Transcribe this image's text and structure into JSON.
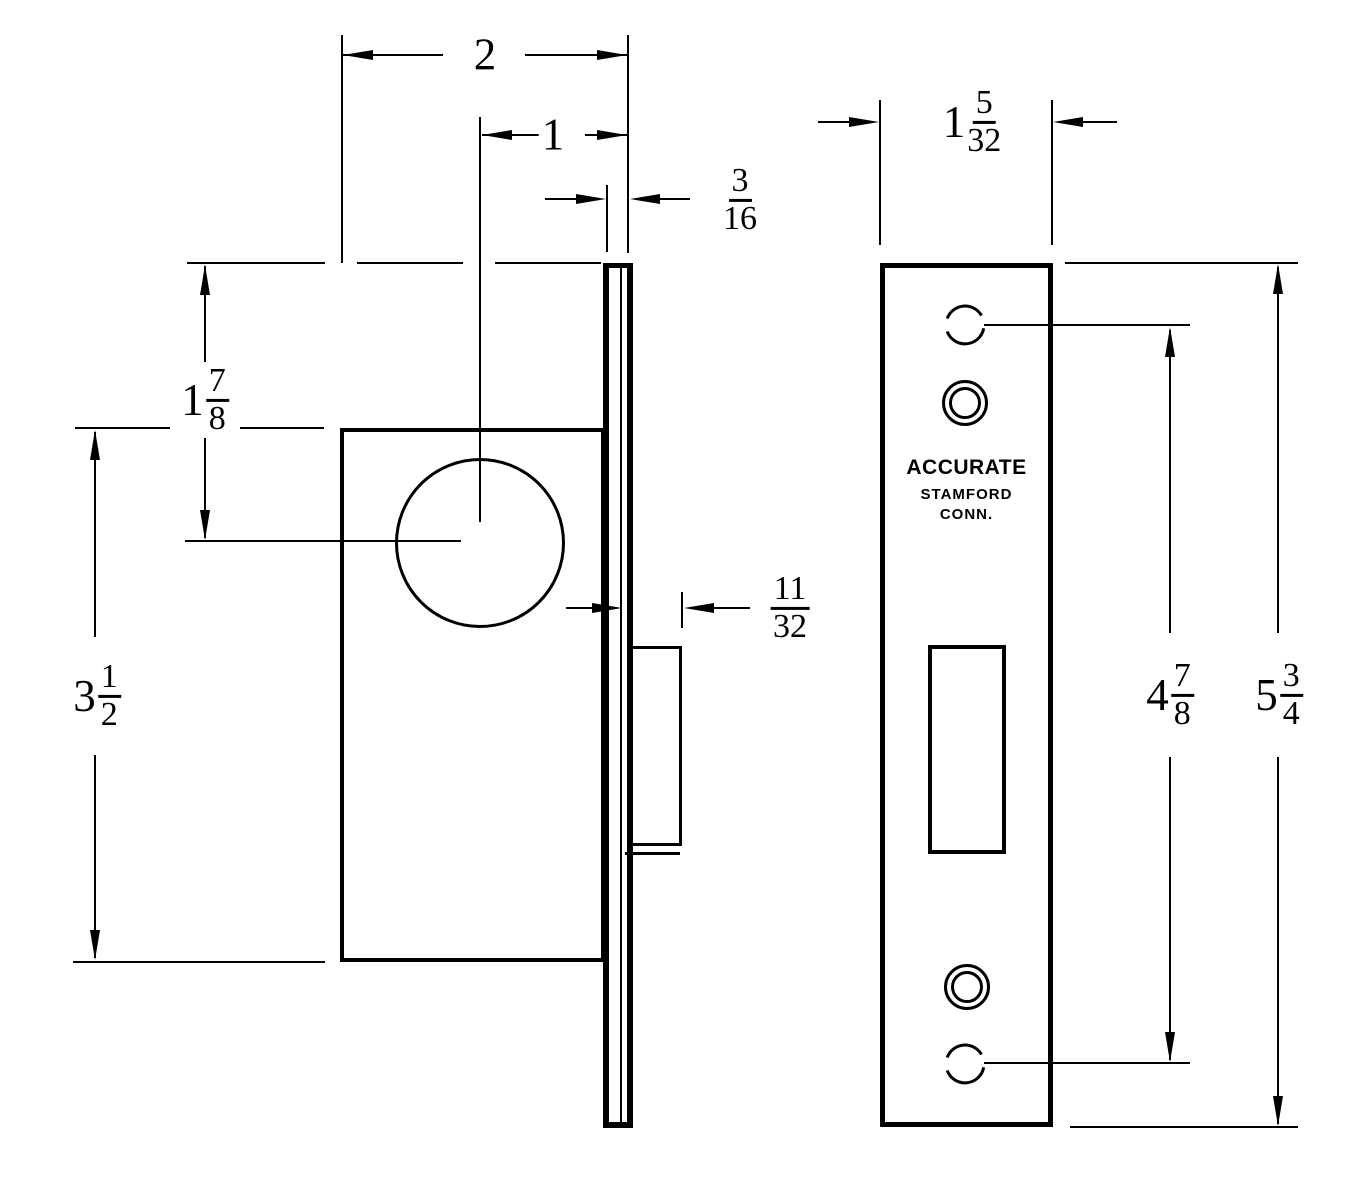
{
  "brand": {
    "line1": "ACCURATE",
    "line2": "STAMFORD",
    "line3": "CONN."
  },
  "dimensions": {
    "case_depth": {
      "whole": "2"
    },
    "backset": {
      "whole": "1"
    },
    "front_thickness": {
      "num": "3",
      "den": "16"
    },
    "top_to_hub": {
      "whole": "1",
      "num": "7",
      "den": "8"
    },
    "case_height": {
      "whole": "3",
      "num": "1",
      "den": "2"
    },
    "bolt_projection": {
      "num": "11",
      "den": "32"
    },
    "front_width": {
      "whole": "1",
      "num": "5",
      "den": "32"
    },
    "screw_spacing": {
      "whole": "4",
      "num": "7",
      "den": "8"
    },
    "front_height": {
      "whole": "5",
      "num": "3",
      "den": "4"
    }
  }
}
